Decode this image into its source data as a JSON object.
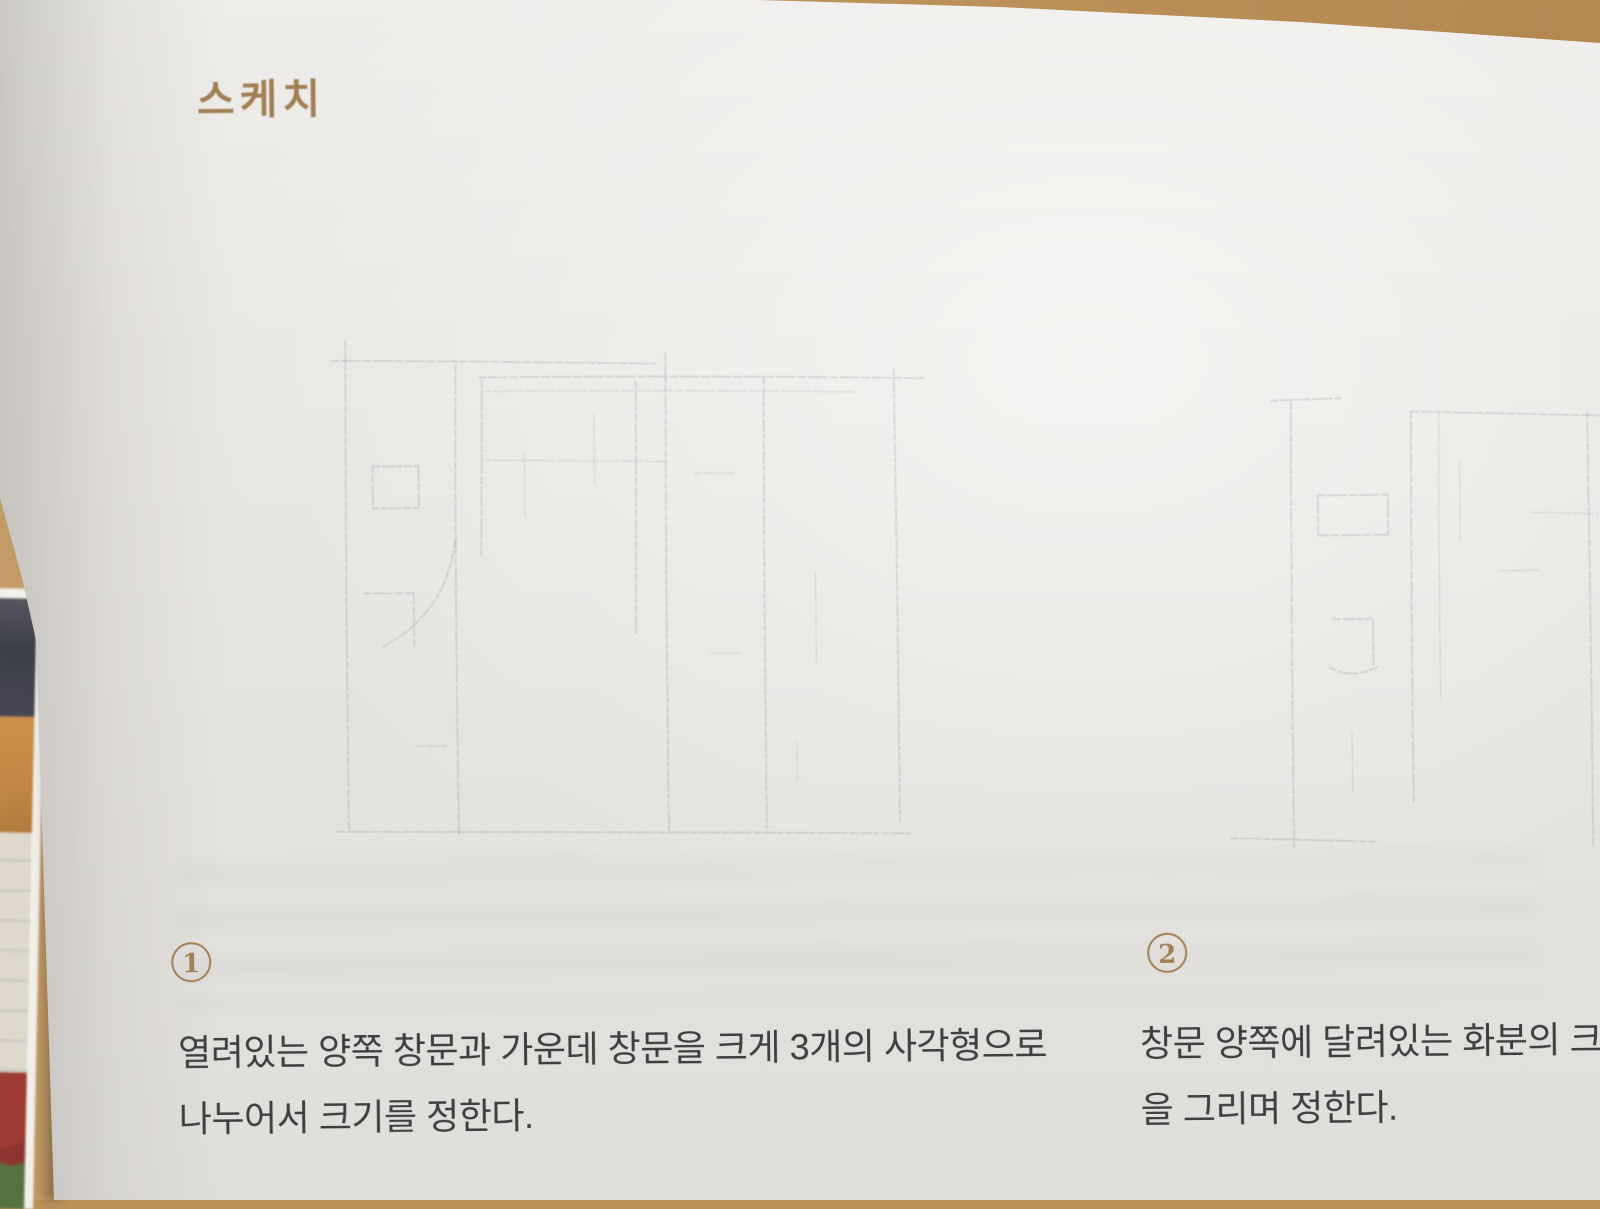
{
  "page_title": "스케치",
  "steps": [
    {
      "number": "1",
      "caption_lines": [
        "열려있는 양쪽 창문과 가운데 창문을 크게 3개의 사각형으로",
        "나누어서 크기를 정한다."
      ]
    },
    {
      "number": "2",
      "caption_lines": [
        "창문 양쪽에 달려있는 화분의 크기와",
        "을 그리며 정한다."
      ]
    }
  ],
  "colors": {
    "desk": "#bb9059",
    "page": "#e9e7e3",
    "accent-brown": "#a28055",
    "text": "#3f3f42"
  }
}
